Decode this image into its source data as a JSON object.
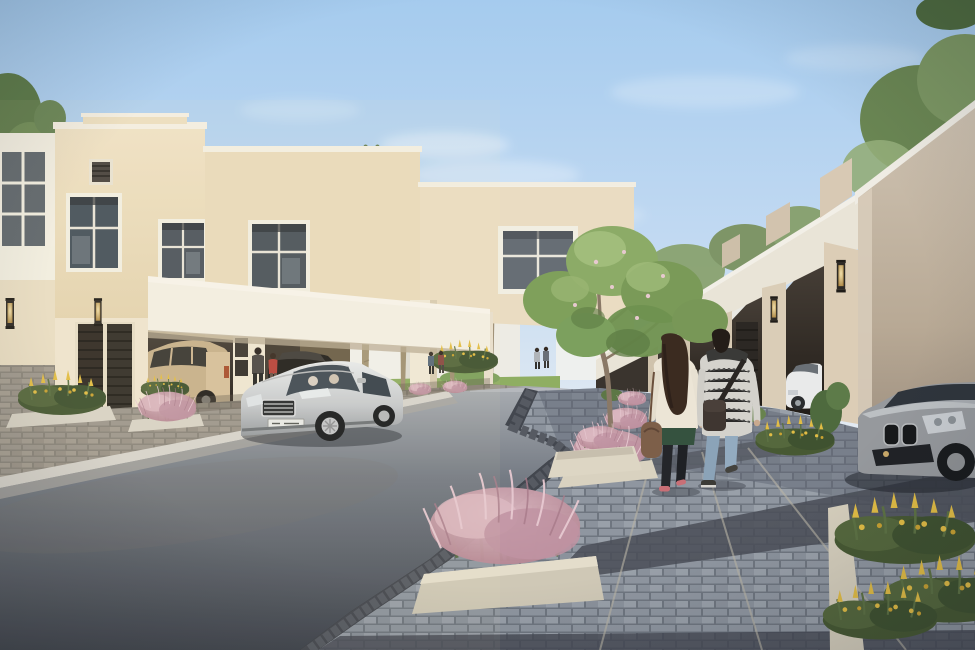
{
  "scene": {
    "title": "Residential community street rendering",
    "description": "Sunny rendered street of a villa community: cream two-storey townhouses with carports on the left, a row of single-storey garage fronts on the right, date palms, a silver sedan on the road, a parked SUV and BMW, and a couple strolling on a paved sidewalk lined with pink fountain-grass planters and yellow flowers.",
    "palette": {
      "sky_top": "#a5cbee",
      "sky_mid": "#c3daf2",
      "sky_horizon": "#e9eef3",
      "cloud": "#ffffff",
      "villa_wall": "#ecdfc1",
      "villa_wall_shade": "#e2d1ae",
      "villa_trim": "#f3efe3",
      "window_glass": "#47525c",
      "door_dark": "#322c26",
      "carport_shadow": "#38312a",
      "garage_wall": "#d6c9b3",
      "garage_wall_shade": "#b3a38e",
      "garage_fascia": "#e9e4d7",
      "sconce_glow": "#e6cf96",
      "road_near": "#3c414b",
      "road_far": "#a9adb2",
      "curb_white": "#d7d4cd",
      "curb_band": "#43474f",
      "paver_light": "#8f96a0",
      "paver_dark": "#4a4e57",
      "planter_box": "#d9d2c0",
      "lawn": "#8fae62",
      "palm_frond": "#6b8052",
      "palm_trunk": "#a09173",
      "tree_canopy": "#83a263",
      "bush_pink": "#c795a4",
      "flower_yellow": "#e2bd45",
      "bed_green": "#475933",
      "sedan_silver": "#cfd2d5",
      "sedan_glass": "#424c56",
      "suv_champagne": "#c7b18c",
      "bmw_gray": "#96999d",
      "bmw_glass": "#2f353c",
      "white_car": "#e9eaea",
      "skin": "#c9a98e",
      "woman_cardigan": "#ece5d6",
      "woman_hem_green": "#35523f",
      "woman_pants": "#24262a",
      "woman_bag": "#7d5f49",
      "woman_hair": "#3b2b20",
      "man_sweater": "#d4d2cc",
      "man_jeans": "#8ba3b8",
      "man_bag": "#3f3631",
      "shadow": "#262b33"
    },
    "objects": [
      {
        "name": "left-villa",
        "desc": "cream two-storey townhouse block with stepped parapets, four framed windows, louvred attic vent and carport"
      },
      {
        "name": "carport",
        "desc": "white carport slab with pillars, wall sconces, dark slatted doors, parked champagne SUV and dark car"
      },
      {
        "name": "right-garages",
        "desc": "receding row of single-storey garage fronts with white fascias, sconces, dark doors, parked white car"
      },
      {
        "name": "palms",
        "desc": "six date palms along the street"
      },
      {
        "name": "frangipani-tree",
        "desc": "green leafy tree over the sidewalk planter"
      },
      {
        "name": "sedan",
        "desc": "silver luxury sedan driving toward viewer"
      },
      {
        "name": "bmw",
        "desc": "grey coupe parked on right driveway, partially cropped"
      },
      {
        "name": "couple",
        "desc": "woman in cream cardigan with brown bag and man in patterned sweater with crossbody bag walking away holding hands"
      },
      {
        "name": "pedestrians-distant",
        "desc": "small figures near carport and far sidewalk"
      },
      {
        "name": "planters",
        "desc": "pink fountain-grass mounds and yellow flower beds in cream concrete planters"
      }
    ],
    "counts": {
      "palms": 6,
      "foreground_people": 2,
      "midground_people": 2,
      "distant_people": 4,
      "vehicles": 5
    }
  }
}
